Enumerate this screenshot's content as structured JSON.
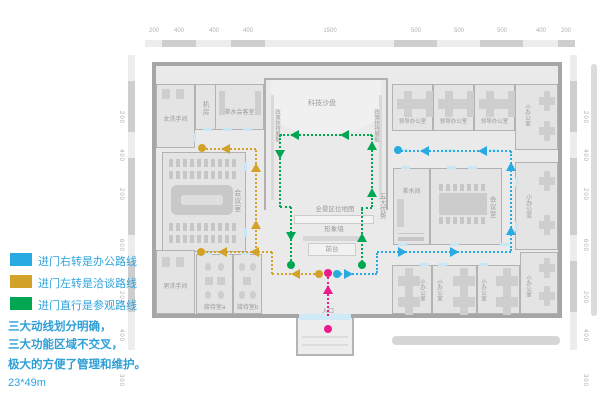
{
  "colors": {
    "office_route": "#29abe2",
    "negotiation_route": "#d3a229",
    "tour_route": "#00a651",
    "entrance_route": "#ec1a8c"
  },
  "legend": {
    "items": [
      {
        "label": "进门右转是办公路线",
        "color": "#29abe2"
      },
      {
        "label": "进门左转是洽谈路线",
        "color": "#d3a229"
      },
      {
        "label": "进门直行是参观路线",
        "color": "#00a651"
      }
    ],
    "note_line1": "三大动线划分明确，",
    "note_line2": "三大功能区域不交叉，",
    "note_line3": "极大的方便了管理和维护。",
    "dimension": "23*49m"
  },
  "rulers": {
    "top": [
      "200",
      "400",
      "400",
      "400",
      "1500",
      "500",
      "500",
      "500",
      "400",
      "200"
    ],
    "left": [
      "200",
      "400",
      "200",
      "600",
      "200",
      "400",
      "300"
    ],
    "right": [
      "200",
      "400",
      "200",
      "600",
      "200",
      "400",
      "300"
    ]
  },
  "rooms": {
    "women_restroom": "女洗手间",
    "machine_room": "机房",
    "tea_meeting_room": "茶水会客室",
    "tech_sand_table": "科技沙盘",
    "policy_board_left": "政策扶持展板",
    "policy_board_right": "政策扶持展板",
    "five_advantages": "五大优势",
    "panorama_map": "全景区位地图",
    "image_wall": "形象墙",
    "front_desk": "前台",
    "meeting_room_left": "会议室",
    "men_restroom": "男洗手间",
    "reception_a": "接待室a",
    "reception_b": "接待室b",
    "leader_office_1": "领导办公室",
    "leader_office_2": "领导办公室",
    "leader_office_3": "领导办公室",
    "small_office_top_right": "小办公室",
    "tea_room": "茶水间",
    "meeting_room_right": "会议室",
    "small_office_mid_right": "小办公室",
    "small_office_b1": "小办公室",
    "small_office_b2": "小办公室",
    "small_office_b3": "小办公室",
    "small_office_bottom_right": "小办公室",
    "entrance": "入口"
  }
}
